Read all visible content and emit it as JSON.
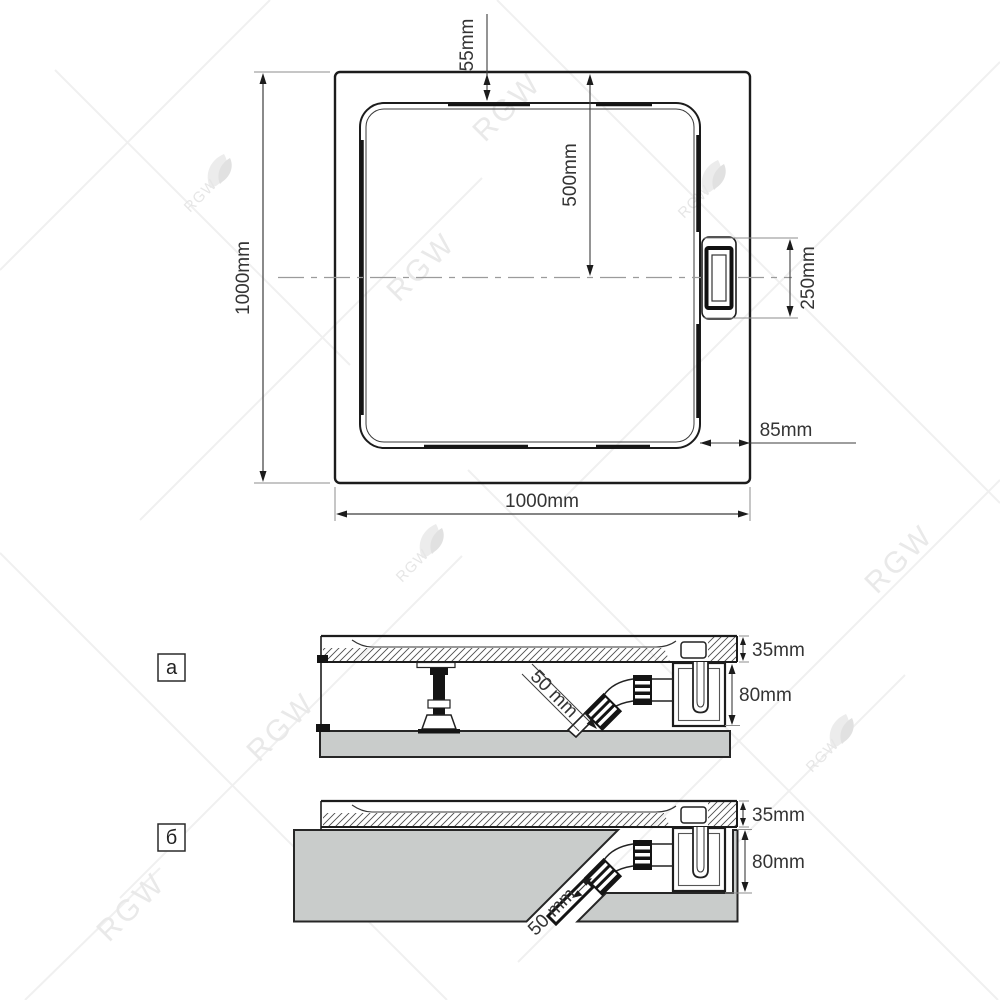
{
  "top_view": {
    "width_label": "1000mm",
    "height_label": "1000mm",
    "edge_to_basin_top_label": "55mm",
    "edge_to_center_label": "500mm",
    "drain_length_label": "250mm",
    "edge_to_basin_side_label": "85mm"
  },
  "sections": {
    "a": {
      "label": "а",
      "rim_height_label": "35mm",
      "siphon_height_label": "80mm",
      "pipe_diameter_label": "50 mm"
    },
    "b": {
      "label": "б",
      "rim_height_label": "35mm",
      "siphon_height_label": "80mm",
      "pipe_diameter_label": "50 mm"
    }
  },
  "watermark": {
    "brand": "RGW"
  },
  "colors": {
    "line": "#1c1c1c",
    "dimension": "#3c3c3c",
    "extension": "#8c8c8c",
    "centerline": "#9b9b9b",
    "slab_fill": "#c9cccb",
    "watermark": "#e9e9e9"
  }
}
